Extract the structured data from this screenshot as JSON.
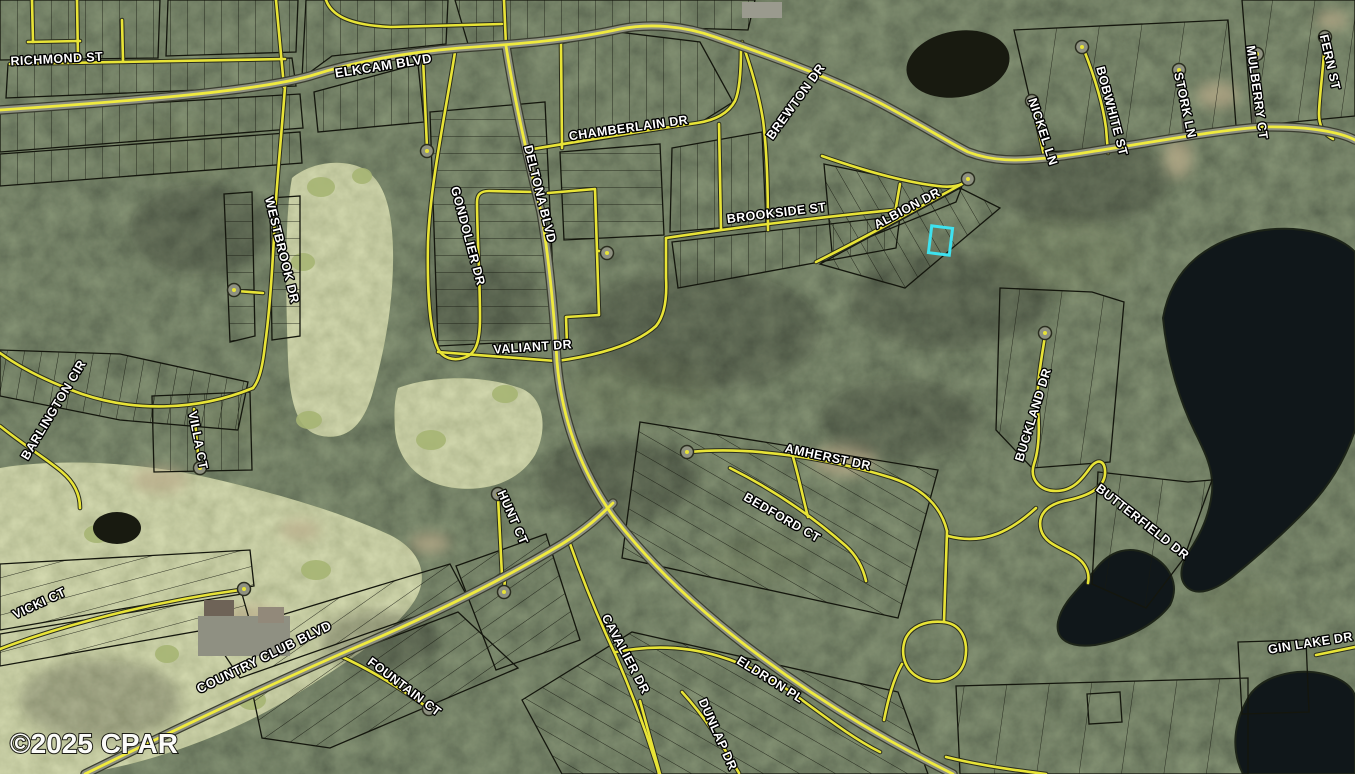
{
  "map": {
    "attribution": "©2025 CPAR",
    "canvas": {
      "w": 1355,
      "h": 774
    },
    "colors": {
      "road_yellow": "#e8e437",
      "road_gray": "#8e9181",
      "road_dark_edge": "#2a2d1f",
      "major_edge": "#3a3d30",
      "dirt_road": "#55564a",
      "parcel_line": "#14160d",
      "water": "#10171a",
      "pond": "#181a10",
      "label_fill": "#ffffff",
      "label_halo": "#000000",
      "highlight": "#3ee2ef",
      "green": "#a6b573",
      "sand": "#b9ac8a"
    },
    "highlight": {
      "x": 930,
      "y": 227,
      "w": 21,
      "h": 27,
      "rot": 7
    },
    "labels": [
      {
        "t": "RICHMOND ST",
        "x": 57,
        "y": 63,
        "r": -3,
        "s": 12.5
      },
      {
        "t": "ELKCAM BLVD",
        "x": 384,
        "y": 70,
        "r": -9,
        "s": 13
      },
      {
        "t": "CHAMBERLAIN DR",
        "x": 629,
        "y": 132,
        "r": -8,
        "s": 12.5
      },
      {
        "t": "BREWTON DR",
        "x": 799,
        "y": 104,
        "r": -54,
        "s": 12.5
      },
      {
        "t": "NICKEL LN",
        "x": 1039,
        "y": 133,
        "r": 72,
        "s": 12.5
      },
      {
        "t": "BOBWHITE ST",
        "x": 1108,
        "y": 112,
        "r": 75,
        "s": 12.5
      },
      {
        "t": "STORK LN",
        "x": 1181,
        "y": 106,
        "r": 78,
        "s": 12.5
      },
      {
        "t": "MULBERRY CT",
        "x": 1253,
        "y": 93,
        "r": 82,
        "s": 12.5
      },
      {
        "t": "FERN ST",
        "x": 1326,
        "y": 63,
        "r": 77,
        "s": 12.5
      },
      {
        "t": "ALBION DR",
        "x": 909,
        "y": 212,
        "r": -28,
        "s": 12.5
      },
      {
        "t": "BROOKSIDE ST",
        "x": 777,
        "y": 217,
        "r": -7,
        "s": 12.5
      },
      {
        "t": "WESTBROOK DR",
        "x": 278,
        "y": 251,
        "r": 76,
        "s": 12.5
      },
      {
        "t": "GONDOLIER DR",
        "x": 464,
        "y": 237,
        "r": 75,
        "s": 12.5
      },
      {
        "t": "DELTONA BLVD",
        "x": 536,
        "y": 195,
        "r": 76,
        "s": 12.5
      },
      {
        "t": "VALIANT DR",
        "x": 533,
        "y": 351,
        "r": -4,
        "s": 12.5
      },
      {
        "t": "BARLINGTON CIR",
        "x": 57,
        "y": 412,
        "r": -59,
        "s": 12.5
      },
      {
        "t": "VILLA CT",
        "x": 194,
        "y": 441,
        "r": 79,
        "s": 12.5
      },
      {
        "t": "HUNT CT",
        "x": 509,
        "y": 519,
        "r": 66,
        "s": 12.5
      },
      {
        "t": "VICKI CT",
        "x": 41,
        "y": 607,
        "r": -25,
        "s": 12.5
      },
      {
        "t": "COUNTRY CLUB BLVD",
        "x": 266,
        "y": 661,
        "r": -26,
        "s": 13
      },
      {
        "t": "FOUNTAIN CT",
        "x": 402,
        "y": 690,
        "r": 37,
        "s": 12.5
      },
      {
        "t": "AMHERST DR",
        "x": 827,
        "y": 461,
        "r": 12,
        "s": 12.5
      },
      {
        "t": "BEDFORD CT",
        "x": 780,
        "y": 521,
        "r": 30,
        "s": 12.5
      },
      {
        "t": "CAVALIER DR",
        "x": 622,
        "y": 656,
        "r": 62,
        "s": 12.5
      },
      {
        "t": "ELDRON PL",
        "x": 768,
        "y": 683,
        "r": 32,
        "s": 12.5
      },
      {
        "t": "DUNLAP DR",
        "x": 714,
        "y": 736,
        "r": 66,
        "s": 12.5
      },
      {
        "t": "BUCKLAND DR",
        "x": 1037,
        "y": 416,
        "r": -73,
        "s": 12.5
      },
      {
        "t": "BUTTERFIELD DR",
        "x": 1140,
        "y": 525,
        "r": 38,
        "s": 12.5
      },
      {
        "t": "GIN LAKE DR",
        "x": 1311,
        "y": 647,
        "r": -9,
        "s": 12.5
      }
    ],
    "roads": [
      {
        "n": "elkcam-blvd",
        "t": "major",
        "d": "M 0,110 C 150,100 260,90 310,76 C 350,63 400,53 460,48 C 520,44 570,40 620,29 C 650,23 685,26 715,37 C 765,54 825,75 880,103 C 920,124 948,142 968,152 C 992,161 1015,162 1055,157 C 1110,150 1205,131 1262,127 C 1312,126 1342,133 1355,140"
      },
      {
        "n": "deltona-blvd-north",
        "t": "minor",
        "d": "M 504,0 L 506,46"
      },
      {
        "n": "deltona-blvd",
        "t": "major",
        "d": "M 506,46 C 516,110 531,170 541,212 C 549,258 554,312 557,362 C 562,420 581,471 613,516 C 649,563 701,613 761,657 C 831,709 891,743 953,774"
      },
      {
        "n": "country-club-blvd",
        "t": "major",
        "d": "M 85,774 C 150,742 262,688 352,649 C 432,615 502,580 562,544 C 586,529 601,515 613,503"
      },
      {
        "n": "richmond-st",
        "t": "minor",
        "d": "M 10,64 L 285,59"
      },
      {
        "n": "top-curve-rd",
        "t": "minor",
        "d": "M 326,0 C 331,14 346,25 391,27 L 502,24"
      },
      {
        "n": "side-st-1",
        "t": "minor",
        "d": "M 32,0 L 33,42"
      },
      {
        "n": "side-st-2",
        "t": "minor",
        "d": "M 77,0 L 78,60"
      },
      {
        "n": "side-st-3",
        "t": "minor",
        "d": "M 28,42 L 80,41"
      },
      {
        "n": "side-st-4",
        "t": "minor",
        "d": "M 122,20 L 123,61"
      },
      {
        "n": "side-st-5",
        "t": "minor",
        "d": "M 276,0 L 284,87"
      },
      {
        "n": "elkcam-stub",
        "t": "minor",
        "d": "M 423,58 L 427,148"
      },
      {
        "n": "gondolier-dr",
        "t": "minor",
        "d": "M 455,52 C 446,110 430,185 428,242 C 427,292 430,332 438,349 C 443,358 453,361 463,358 C 475,355 480,344 480,318 C 480,278 477,232 477,202 C 477,194 481,191 489,191 L 536,192"
      },
      {
        "n": "block-loop-rd",
        "t": "minor",
        "d": "M 548,193 L 595,189 L 599,315 L 566,317 L 567,346"
      },
      {
        "n": "loop-stub",
        "t": "minor",
        "d": "M 599,251 L 605,252"
      },
      {
        "n": "valiant-dr-west",
        "t": "minor",
        "d": "M 438,352 L 556,361"
      },
      {
        "n": "valiant-dr-east",
        "t": "minor",
        "d": "M 557,361 C 600,355 636,344 656,326 C 665,315 667,296 666,278 L 666,238"
      },
      {
        "n": "chamberlain-dr",
        "t": "minor",
        "d": "M 527,150 C 605,137 662,128 697,123 C 717,120 729,112 735,101 C 740,90 741,68 741,48"
      },
      {
        "n": "chamberlain-vert",
        "t": "minor",
        "d": "M 561,42 L 562,148"
      },
      {
        "n": "brewton-dr",
        "t": "minor",
        "d": "M 742,42 C 752,70 759,95 763,120 C 767,150 768,192 768,230"
      },
      {
        "n": "brookside-vert",
        "t": "minor",
        "d": "M 719,124 L 721,229"
      },
      {
        "n": "brookside-st",
        "t": "minor",
        "d": "M 666,238 C 700,233 734,228 768,224 C 800,220 852,214 903,209"
      },
      {
        "n": "albion-back-st",
        "t": "minor",
        "d": "M 822,156 C 862,170 902,182 938,186 C 953,188 962,185 966,181"
      },
      {
        "n": "albion-dr",
        "t": "minor",
        "d": "M 816,262 C 868,236 918,208 962,184"
      },
      {
        "n": "albion-connector",
        "t": "minor",
        "d": "M 900,184 L 895,213"
      },
      {
        "n": "nickel-ln",
        "t": "minor",
        "d": "M 1033,104 L 1044,156"
      },
      {
        "n": "bobwhite-st",
        "t": "minor",
        "d": "M 1084,50 C 1095,78 1103,105 1106,128 L 1108,153"
      },
      {
        "n": "stork-ln",
        "t": "dirt",
        "d": "M 1179,73 L 1184,133"
      },
      {
        "n": "mulberry-ct",
        "t": "dirt",
        "d": "M 1256,57 L 1253,125"
      },
      {
        "n": "fern-st",
        "t": "minor",
        "d": "M 1325,40 C 1323,72 1319,100 1319,114 C 1319,127 1325,135 1333,139"
      },
      {
        "n": "westbrook-dr",
        "t": "minor",
        "d": "M 285,87 C 281,140 277,180 275,215 C 273,260 270,310 265,345 C 262,372 258,382 253,388"
      },
      {
        "n": "westbrook-stub",
        "t": "minor",
        "d": "M 237,291 L 263,293"
      },
      {
        "n": "barlington-cir-outer",
        "t": "minor",
        "d": "M 253,388 C 195,412 132,411 82,394 C 46,381 18,366 0,353"
      },
      {
        "n": "barlington-cir-inner",
        "t": "minor",
        "d": "M 0,426 C 25,446 48,460 62,472 C 75,483 80,495 80,508"
      },
      {
        "n": "villa-ct",
        "t": "minor",
        "d": "M 194,409 L 199,465"
      },
      {
        "n": "vicki-ct",
        "t": "minor",
        "d": "M 0,649 C 60,626 150,602 240,590"
      },
      {
        "n": "hunt-ct-north",
        "t": "minor",
        "d": "M 502,576 L 498,497"
      },
      {
        "n": "hunt-ct-south",
        "t": "minor",
        "d": "M 505,580 L 504,589"
      },
      {
        "n": "fountain-ct",
        "t": "minor",
        "d": "M 338,655 C 372,670 402,690 424,705"
      },
      {
        "n": "cavalier-dr",
        "t": "minor",
        "d": "M 569,541 C 583,581 600,622 616,656 C 632,693 646,731 658,770 L 659,774"
      },
      {
        "n": "amherst-dr",
        "t": "minor",
        "d": "M 690,452 C 752,446 832,459 892,478 C 922,488 941,506 947,531"
      },
      {
        "n": "bedford-ct",
        "t": "minor",
        "d": "M 730,468 C 772,489 812,516 846,546 C 857,556 863,568 866,581"
      },
      {
        "n": "bedford-connector",
        "t": "minor",
        "d": "M 793,457 C 799,478 803,498 808,517"
      },
      {
        "n": "loop-vert",
        "t": "minor",
        "d": "M 947,531 L 944,622"
      },
      {
        "n": "loop-circle",
        "t": "minor",
        "d": "M 944,622 C 965,625 968,645 965,660 C 960,680 940,684 925,680 C 905,674 900,655 905,640 C 910,627 925,620 944,622"
      },
      {
        "n": "loop-west-connector",
        "t": "minor",
        "d": "M 902,664 C 893,680 888,700 884,720"
      },
      {
        "n": "eldron-pl",
        "t": "minor",
        "d": "M 616,652 C 692,637 752,662 802,700 C 832,722 856,740 880,752"
      },
      {
        "n": "dunlap-dr",
        "t": "minor",
        "d": "M 682,692 C 706,718 723,746 739,773"
      },
      {
        "n": "bottom-vert",
        "t": "minor",
        "d": "M 640,701 C 648,731 655,755 660,774"
      },
      {
        "n": "bottom-branch",
        "t": "minor",
        "d": "M 946,757 C 978,765 1012,770 1046,774"
      },
      {
        "n": "butterfield-connector",
        "t": "minor",
        "d": "M 948,536 C 986,546 1013,529 1036,508"
      },
      {
        "n": "buckland-butterfield-dr",
        "t": "minor",
        "d": "M 1045,336 C 1041,362 1036,386 1038,410 C 1040,434 1038,452 1034,464 C 1029,479 1040,491 1056,491 C 1073,491 1082,479 1090,468 C 1098,457 1106,461 1105,474 C 1104,489 1085,497 1064,501 C 1047,505 1037,515 1041,530 C 1045,544 1062,548 1075,556 C 1086,563 1090,573 1088,583"
      },
      {
        "n": "gin-lake-dr",
        "t": "minor",
        "d": "M 1316,655 L 1355,647"
      }
    ],
    "bulbs": [
      [
        427,
        151
      ],
      [
        607,
        253
      ],
      [
        968,
        179
      ],
      [
        1032,
        101
      ],
      [
        1082,
        47
      ],
      [
        1179,
        70
      ],
      [
        1257,
        54
      ],
      [
        1325,
        37
      ],
      [
        234,
        290
      ],
      [
        200,
        468
      ],
      [
        244,
        589
      ],
      [
        498,
        494
      ],
      [
        504,
        592
      ],
      [
        429,
        709
      ],
      [
        687,
        452
      ],
      [
        1045,
        333
      ]
    ],
    "water": {
      "lakes": [
        "M 1163,318 C 1172,266 1210,240 1258,231 C 1305,223 1342,238 1355,252 L 1355,430 C 1345,460 1330,485 1308,508 C 1285,532 1258,556 1232,577 C 1215,590 1198,596 1188,588 C 1178,580 1180,565 1190,550 C 1202,532 1210,512 1212,492 C 1214,470 1205,452 1195,432 C 1180,402 1167,360 1163,318 Z",
        "M 1095,570 C 1110,550 1130,545 1150,555 C 1170,565 1180,585 1170,605 C 1155,625 1125,640 1095,645 C 1070,648 1055,640 1058,622 C 1062,602 1080,588 1095,570 Z",
        "M 1247,700 C 1257,678 1292,667 1324,674 C 1348,680 1356,692 1355,700 L 1355,774 L 1243,774 C 1230,748 1235,722 1247,700 Z"
      ],
      "ponds": [
        [
          958,
          64,
          52,
          33,
          -10
        ],
        [
          117,
          528,
          24,
          16,
          0
        ]
      ]
    },
    "golf": [
      "M 292,178 C 310,163 340,158 362,168 C 385,180 392,210 393,250 C 394,300 385,350 372,395 C 362,428 345,440 322,436 C 300,432 290,410 288,360 C 286,300 284,220 292,178 Z",
      "M 398,388 C 430,376 480,374 520,388 C 545,397 548,430 535,455 C 520,480 490,492 455,488 C 420,484 398,462 395,430 C 394,415 394,400 398,388 Z",
      "M 0,468 C 60,458 140,462 210,478 C 280,494 340,512 390,535 C 420,550 430,575 415,600 C 395,632 350,660 300,692 C 240,730 160,762 80,774 L 0,774 Z"
    ],
    "greens": [
      [
        321,
        187,
        14,
        10
      ],
      [
        303,
        262,
        12,
        9
      ],
      [
        309,
        420,
        13,
        9
      ],
      [
        431,
        440,
        15,
        10
      ],
      [
        505,
        394,
        13,
        9
      ],
      [
        97,
        534,
        13,
        9
      ],
      [
        316,
        570,
        15,
        10
      ],
      [
        252,
        700,
        14,
        10
      ],
      [
        167,
        654,
        12,
        9
      ],
      [
        362,
        176,
        10,
        8
      ]
    ],
    "sand": [
      [
        160,
        480,
        28,
        13
      ],
      [
        250,
        620,
        33,
        15
      ],
      [
        430,
        543,
        20,
        10
      ],
      [
        845,
        460,
        32,
        16
      ],
      [
        1218,
        95,
        21,
        13
      ],
      [
        1178,
        158,
        14,
        20
      ],
      [
        1332,
        20,
        16,
        9
      ],
      [
        300,
        530,
        20,
        10
      ]
    ],
    "shade": [
      [
        700,
        330,
        120,
        60
      ],
      [
        950,
        300,
        100,
        50
      ],
      [
        480,
        300,
        60,
        40
      ],
      [
        200,
        230,
        70,
        45
      ],
      [
        1080,
        180,
        90,
        45
      ],
      [
        620,
        480,
        80,
        40
      ],
      [
        380,
        640,
        60,
        30
      ],
      [
        900,
        420,
        80,
        40
      ],
      [
        100,
        700,
        80,
        40
      ]
    ],
    "scrub": [
      [
        180,
        150,
        60,
        30
      ],
      [
        640,
        390,
        70,
        35
      ],
      [
        1060,
        255,
        75,
        40
      ],
      [
        760,
        560,
        50,
        25
      ],
      [
        240,
        420,
        40,
        20
      ],
      [
        1240,
        600,
        40,
        20
      ]
    ],
    "structures": [
      [
        198,
        616,
        92,
        40,
        "#8f9082"
      ],
      [
        204,
        600,
        30,
        16,
        "#6e6357"
      ],
      [
        258,
        607,
        26,
        16,
        "#92897a"
      ],
      [
        742,
        2,
        40,
        16,
        "#9a9a8e"
      ]
    ],
    "blocks": [
      {
        "p": "0,0 160,0 158,58 0,60",
        "f": "pv"
      },
      {
        "p": "168,0 298,0 296,52 166,56",
        "f": "pv"
      },
      {
        "p": "8,64 292,58 296,86 6,98",
        "f": "pv"
      },
      {
        "p": "306,0 448,0 446,44 332,56 302,78",
        "f": "pv"
      },
      {
        "p": "455,0 755,0 748,30 620,26 560,40 468,44",
        "f": "pv"
      },
      {
        "p": "0,112 300,94 303,128 0,152",
        "f": "pv"
      },
      {
        "p": "0,154 300,132 302,163 0,186",
        "f": "pv"
      },
      {
        "p": "314,92 418,64 424,122 318,132",
        "f": "pv"
      },
      {
        "p": "430,112 545,102 556,340 438,346",
        "f": "ph"
      },
      {
        "p": "560,152 660,144 664,235 564,240",
        "f": "ph"
      },
      {
        "p": "560,44 618,32 700,42 733,102 698,124 563,146",
        "f": "pv"
      },
      {
        "p": "672,148 762,132 766,224 670,232",
        "f": "pv"
      },
      {
        "p": "672,242 900,216 896,248 678,288",
        "f": "pv"
      },
      {
        "p": "824,164 940,188 962,186 956,202 832,252",
        "f": "pdm30"
      },
      {
        "p": "820,264 960,188 1000,208 905,288",
        "f": "pdm30"
      },
      {
        "p": "1014,30 1228,20 1236,126 1130,148 1042,152",
        "f": "pvs"
      },
      {
        "p": "1242,0 1355,0 1355,116 1252,126",
        "f": "pvs"
      },
      {
        "p": "224,194 252,192 255,336 230,342",
        "f": "ph"
      },
      {
        "p": "270,198 300,196 300,336 272,340",
        "f": "ph"
      },
      {
        "p": "0,350 120,354 248,382 238,430 120,420 0,396",
        "f": "p10"
      },
      {
        "p": "152,396 250,392 252,470 154,472",
        "f": "pv"
      },
      {
        "p": "0,564 250,550 254,586 0,630",
        "f": "pd75"
      },
      {
        "p": "0,634 242,594 250,622 0,666",
        "f": "pd75"
      },
      {
        "p": "212,636 450,564 468,598 240,678",
        "f": "pd55"
      },
      {
        "p": "252,690 458,612 518,668 330,748 262,738",
        "f": "pd55"
      },
      {
        "p": "456,566 546,534 580,640 496,670",
        "f": "pd55"
      },
      {
        "p": "640,422 938,470 898,618 622,558",
        "f": "pd120"
      },
      {
        "p": "522,700 632,632 898,692 928,774 562,774",
        "f": "pd120"
      },
      {
        "p": "1000,288 1092,292 1124,302 1110,462 1032,468 996,430",
        "f": "pvs"
      },
      {
        "p": "1098,472 1188,482 1212,480 1184,558 1146,608 1092,584",
        "f": "pvs"
      },
      {
        "p": "956,686 1248,678 1248,774 960,774",
        "f": "pvs"
      },
      {
        "p": "1238,642 1306,640 1309,712 1242,714",
        "f": "none"
      },
      {
        "p": "1087,694 1120,692 1122,722 1089,724",
        "f": "none"
      }
    ]
  }
}
